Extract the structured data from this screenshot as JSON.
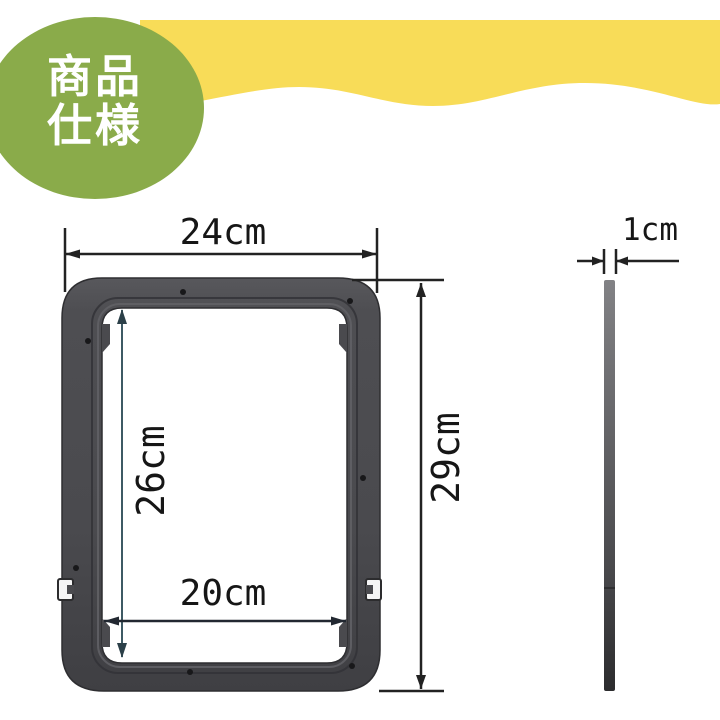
{
  "header": {
    "banner_color": "#f8dc58",
    "badge": {
      "label_line1": "商品",
      "label_line2": "仕様",
      "bg_color": "#8aab4a",
      "text_color": "#ffffff"
    }
  },
  "diagram": {
    "type": "product-dimension-drawing",
    "front_view": {
      "frame_color": "#4b4b4e",
      "labels": {
        "outer_width": "24cm",
        "outer_height": "29cm",
        "inner_height": "26cm",
        "inner_width": "20cm"
      }
    },
    "side_view": {
      "labels": {
        "thickness": "1cm"
      }
    },
    "dimensions_cm": {
      "outer_width": 24,
      "outer_height": 29,
      "inner_width": 20,
      "inner_height": 26,
      "thickness": 1
    }
  }
}
